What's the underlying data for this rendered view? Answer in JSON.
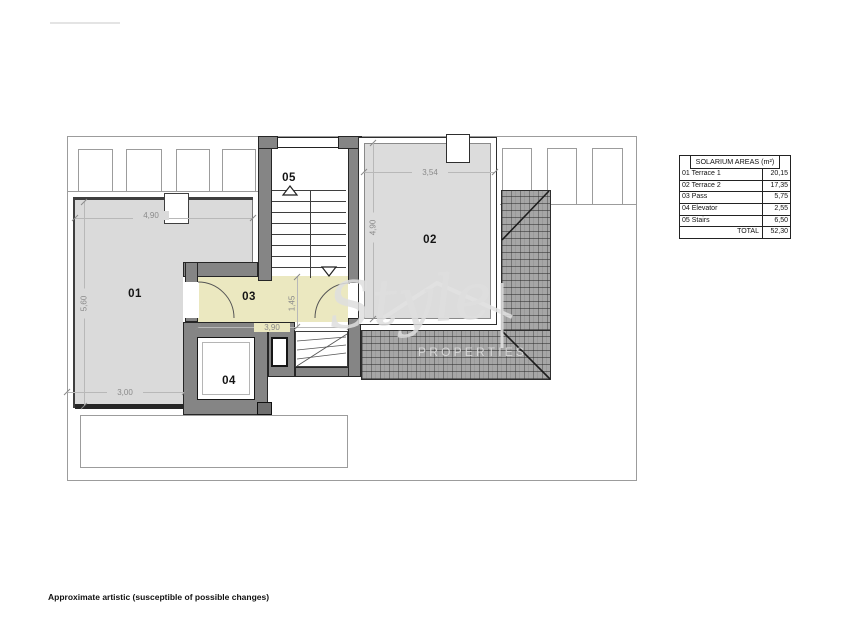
{
  "plan": {
    "rooms": [
      {
        "number": "01"
      },
      {
        "number": "02"
      },
      {
        "number": "03"
      },
      {
        "number": "04"
      },
      {
        "number": "05"
      }
    ],
    "dimensions": {
      "terrace1_width": "4,90",
      "terrace1_depth": "5,60",
      "terrace1_bottom_width": "3,00",
      "pass_width": "3,90",
      "pass_depth": "1,45",
      "terrace2_width": "3,54",
      "terrace2_depth": "4,90"
    }
  },
  "areas_table": {
    "title": "SOLARIUM  AREAS (m²)",
    "rows": [
      {
        "label": "01 Terrace 1",
        "value": "20,15"
      },
      {
        "label": "02 Terrace 2",
        "value": "17,35"
      },
      {
        "label": "03 Pass",
        "value": "5,75"
      },
      {
        "label": "04 Elevator",
        "value": "2,55"
      },
      {
        "label": "05 Stairs",
        "value": "6,50"
      },
      {
        "label": "TOTAL",
        "value": "52,30"
      }
    ]
  },
  "watermark": {
    "brand": "Style",
    "tagline": "PROPERTIES"
  },
  "footer": {
    "disclaimer": "Approximate artistic (susceptible of possible changes)"
  }
}
